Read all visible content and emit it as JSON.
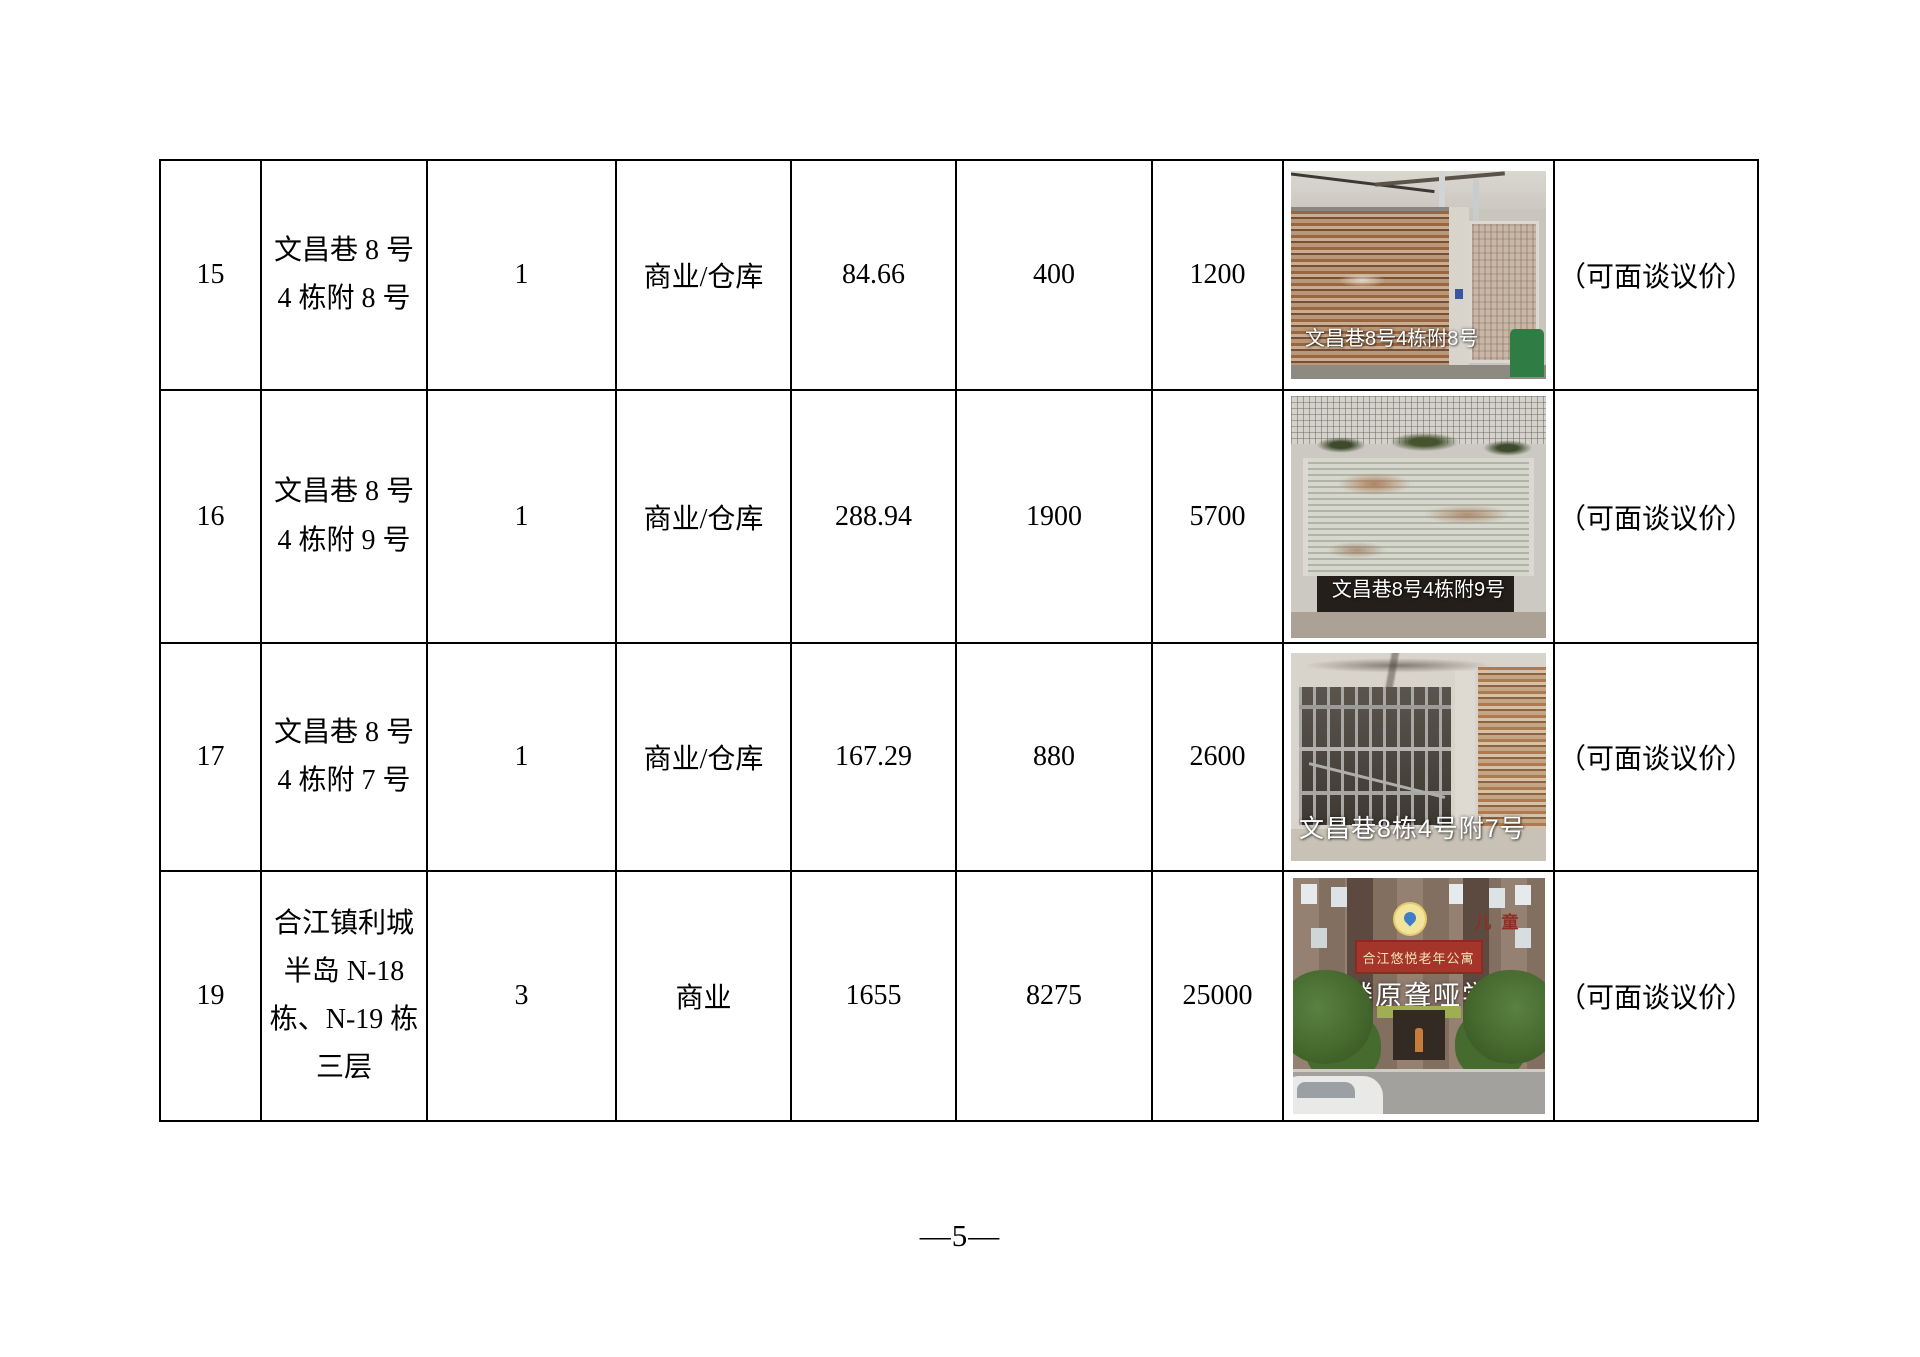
{
  "footer": {
    "page_number": "—5—"
  },
  "table": {
    "rows": [
      {
        "no": "15",
        "location": [
          "文昌巷 8 号",
          "4 栋附 8 号"
        ],
        "quantity": "1",
        "usage": "商业/仓库",
        "area": "84.66",
        "price1": "400",
        "price2": "1200",
        "photo": {
          "caption": "文昌巷8号4栋附8号"
        },
        "remark": "（可面谈议价）"
      },
      {
        "no": "16",
        "location": [
          "文昌巷 8 号",
          "4 栋附 9 号"
        ],
        "quantity": "1",
        "usage": "商业/仓库",
        "area": "288.94",
        "price1": "1900",
        "price2": "5700",
        "photo": {
          "caption": "文昌巷8号4栋附9号"
        },
        "remark": "（可面谈议价）"
      },
      {
        "no": "17",
        "location": [
          "文昌巷 8 号",
          "4 栋附 7 号"
        ],
        "quantity": "1",
        "usage": "商业/仓库",
        "area": "167.29",
        "price1": "880",
        "price2": "2600",
        "photo": {
          "caption": "文昌巷8栋4号附7号"
        },
        "remark": "（可面谈议价）"
      },
      {
        "no": "19",
        "location": [
          "合江镇利城",
          "半岛 N-18",
          "栋、N-19 栋",
          "三层"
        ],
        "quantity": "3",
        "usage": "商业",
        "area": "1655",
        "price1": "8275",
        "price2": "25000",
        "photo": {
          "sign_text": "合江悠悦老年公寓",
          "overlay_text": "三楼原聋哑学校",
          "corner_text": "儿童"
        },
        "remark": "（可面谈议价）"
      }
    ]
  }
}
